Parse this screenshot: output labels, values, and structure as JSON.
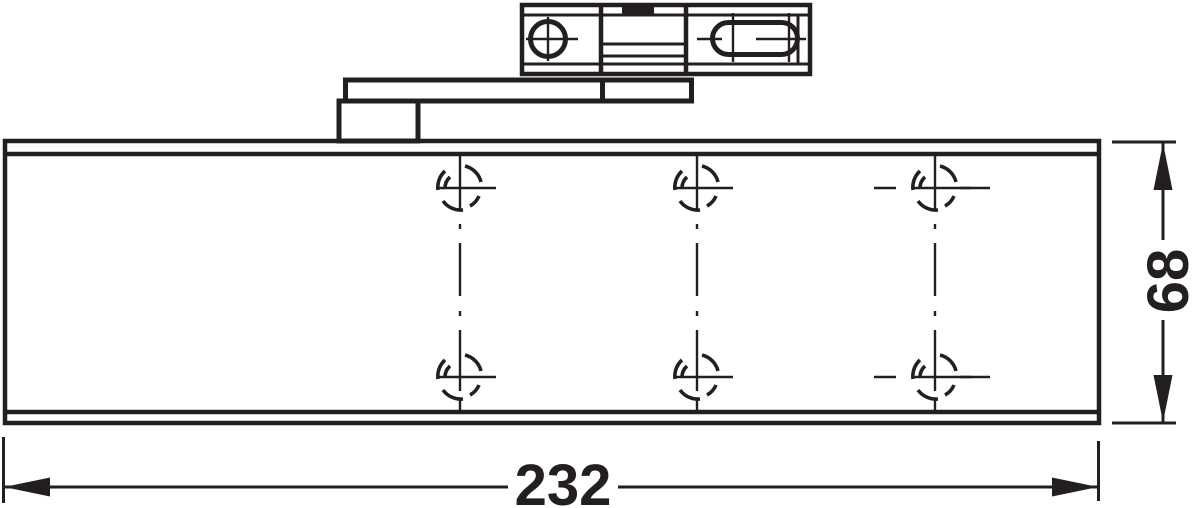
{
  "page": {
    "background_color": "#ffffff"
  },
  "drawing": {
    "kind": "technical-line-drawing",
    "line_color": "#231f20",
    "dimensions": {
      "width_label": "232",
      "height_label": "68"
    },
    "icons": {
      "fixing_point": "screw-fixing-point-icon",
      "screw_hole": "screw-hole-circle-icon",
      "adjustment_slot": "adjustment-slot-icon",
      "arrow_left": "arrow-left-icon",
      "arrow_right": "arrow-right-icon",
      "arrow_up": "arrow-up-icon",
      "arrow_down": "arrow-down-icon"
    },
    "fixing_points": {
      "rows": 2,
      "columns": 3
    }
  }
}
